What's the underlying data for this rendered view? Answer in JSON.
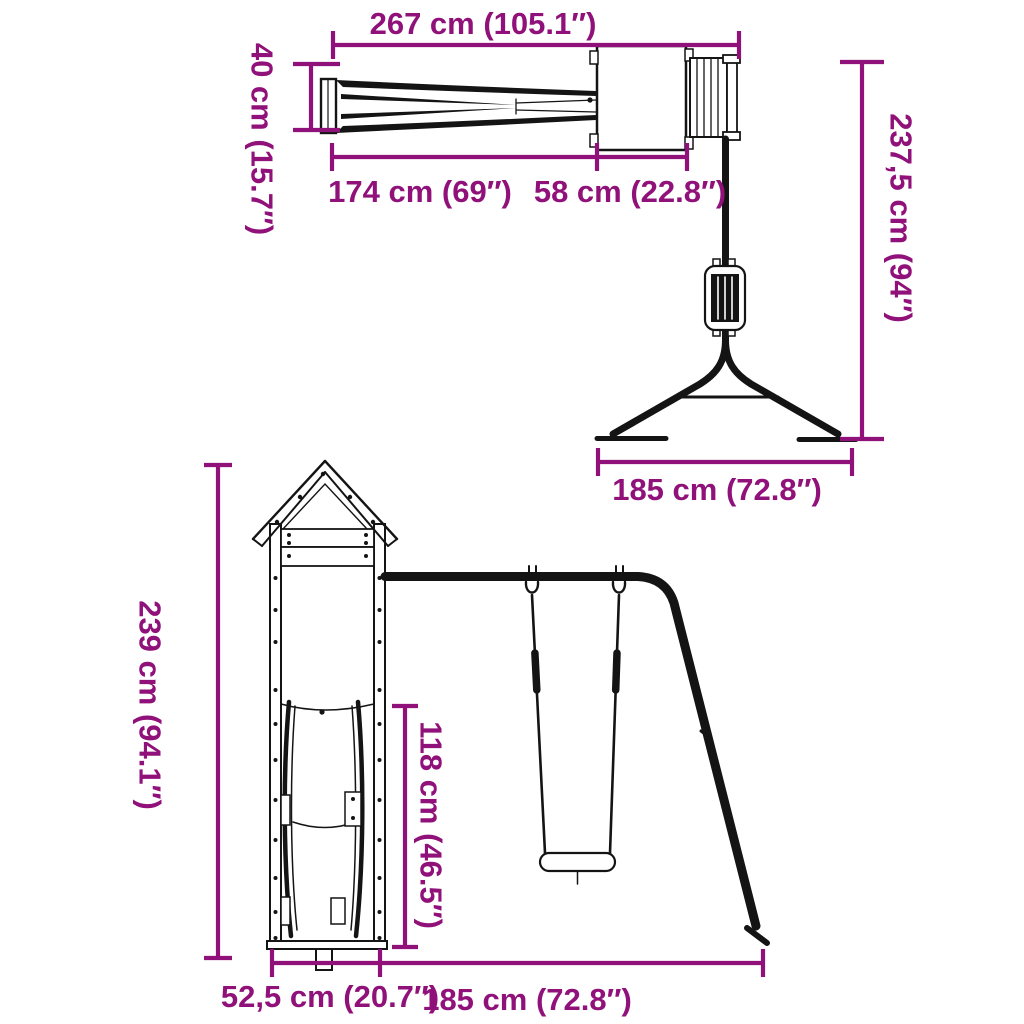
{
  "colors": {
    "dim": "#901179",
    "ink": "#141414",
    "bg": "#ffffff"
  },
  "diagram": {
    "top_view": {
      "total_length_label": "267 cm (105.1″)",
      "slide_width_label": "40 cm (15.7″)",
      "slide_length_label": "174 cm (69″)",
      "platform_depth_label": "58 cm (22.8″)",
      "frame_height_label": "237,5 cm (94″)",
      "frame_depth_label": "185 cm (72.8″)"
    },
    "front_view": {
      "tower_height_label": "239 cm (94.1″)",
      "swing_height_label": "118 cm (46.5″)",
      "tower_width_label": "52,5 cm (20.7″)",
      "swing_span_label": "185 cm (72.8″)"
    }
  }
}
